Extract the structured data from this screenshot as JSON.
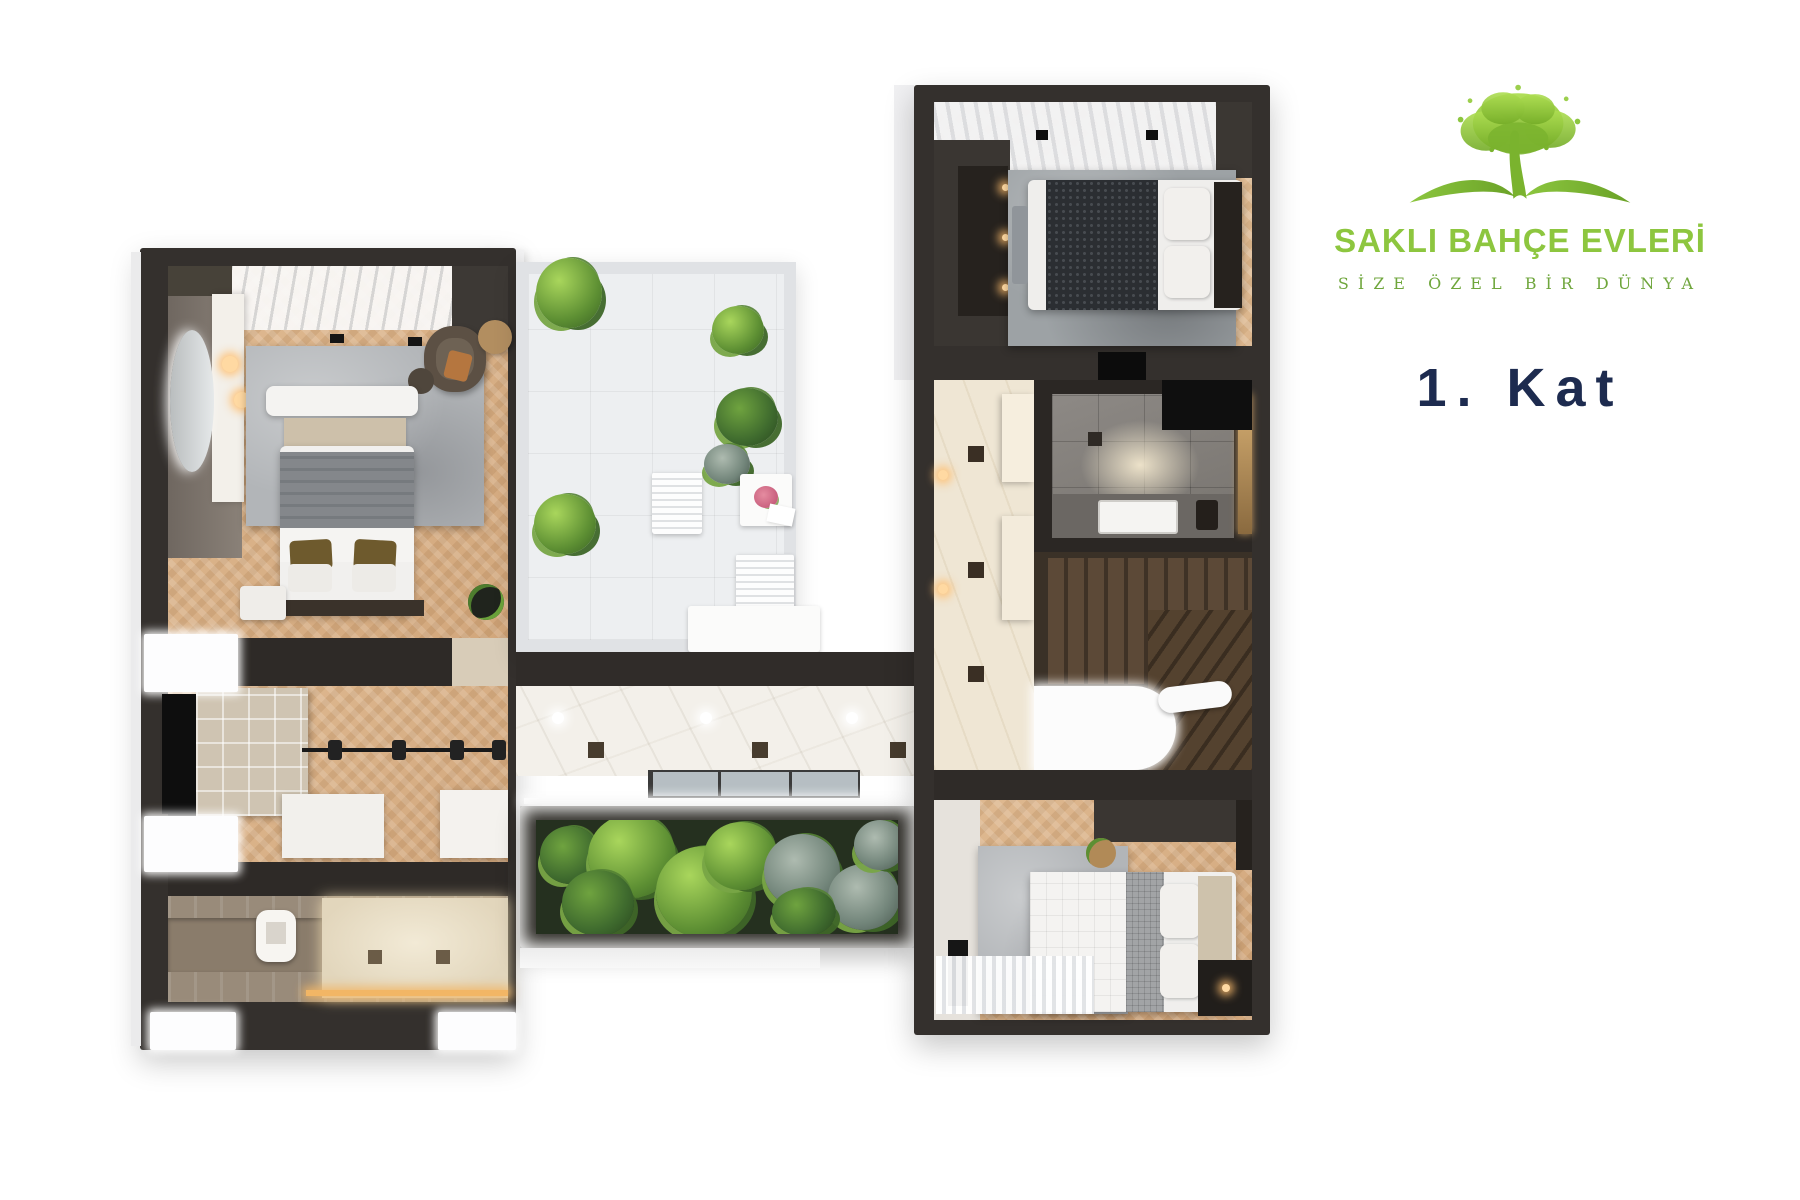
{
  "brand": {
    "title": "SAKLI BAHÇE EVLERİ",
    "tagline": "SİZE ÖZEL BİR DÜNYA",
    "logo_icon": "tree-with-roots"
  },
  "floor": {
    "label": "1. Kat"
  },
  "colors": {
    "brand_green": "#8dc63f",
    "brand_green_dark": "#6fa63c",
    "heading_navy": "#1d2b4f",
    "wall_dark": "#34302d",
    "wood": "#dcb58d",
    "marble": "#f2efe9",
    "rug": "#b3b6b9",
    "plant_green": "#7fba3c",
    "led_warm": "#f2b665"
  }
}
